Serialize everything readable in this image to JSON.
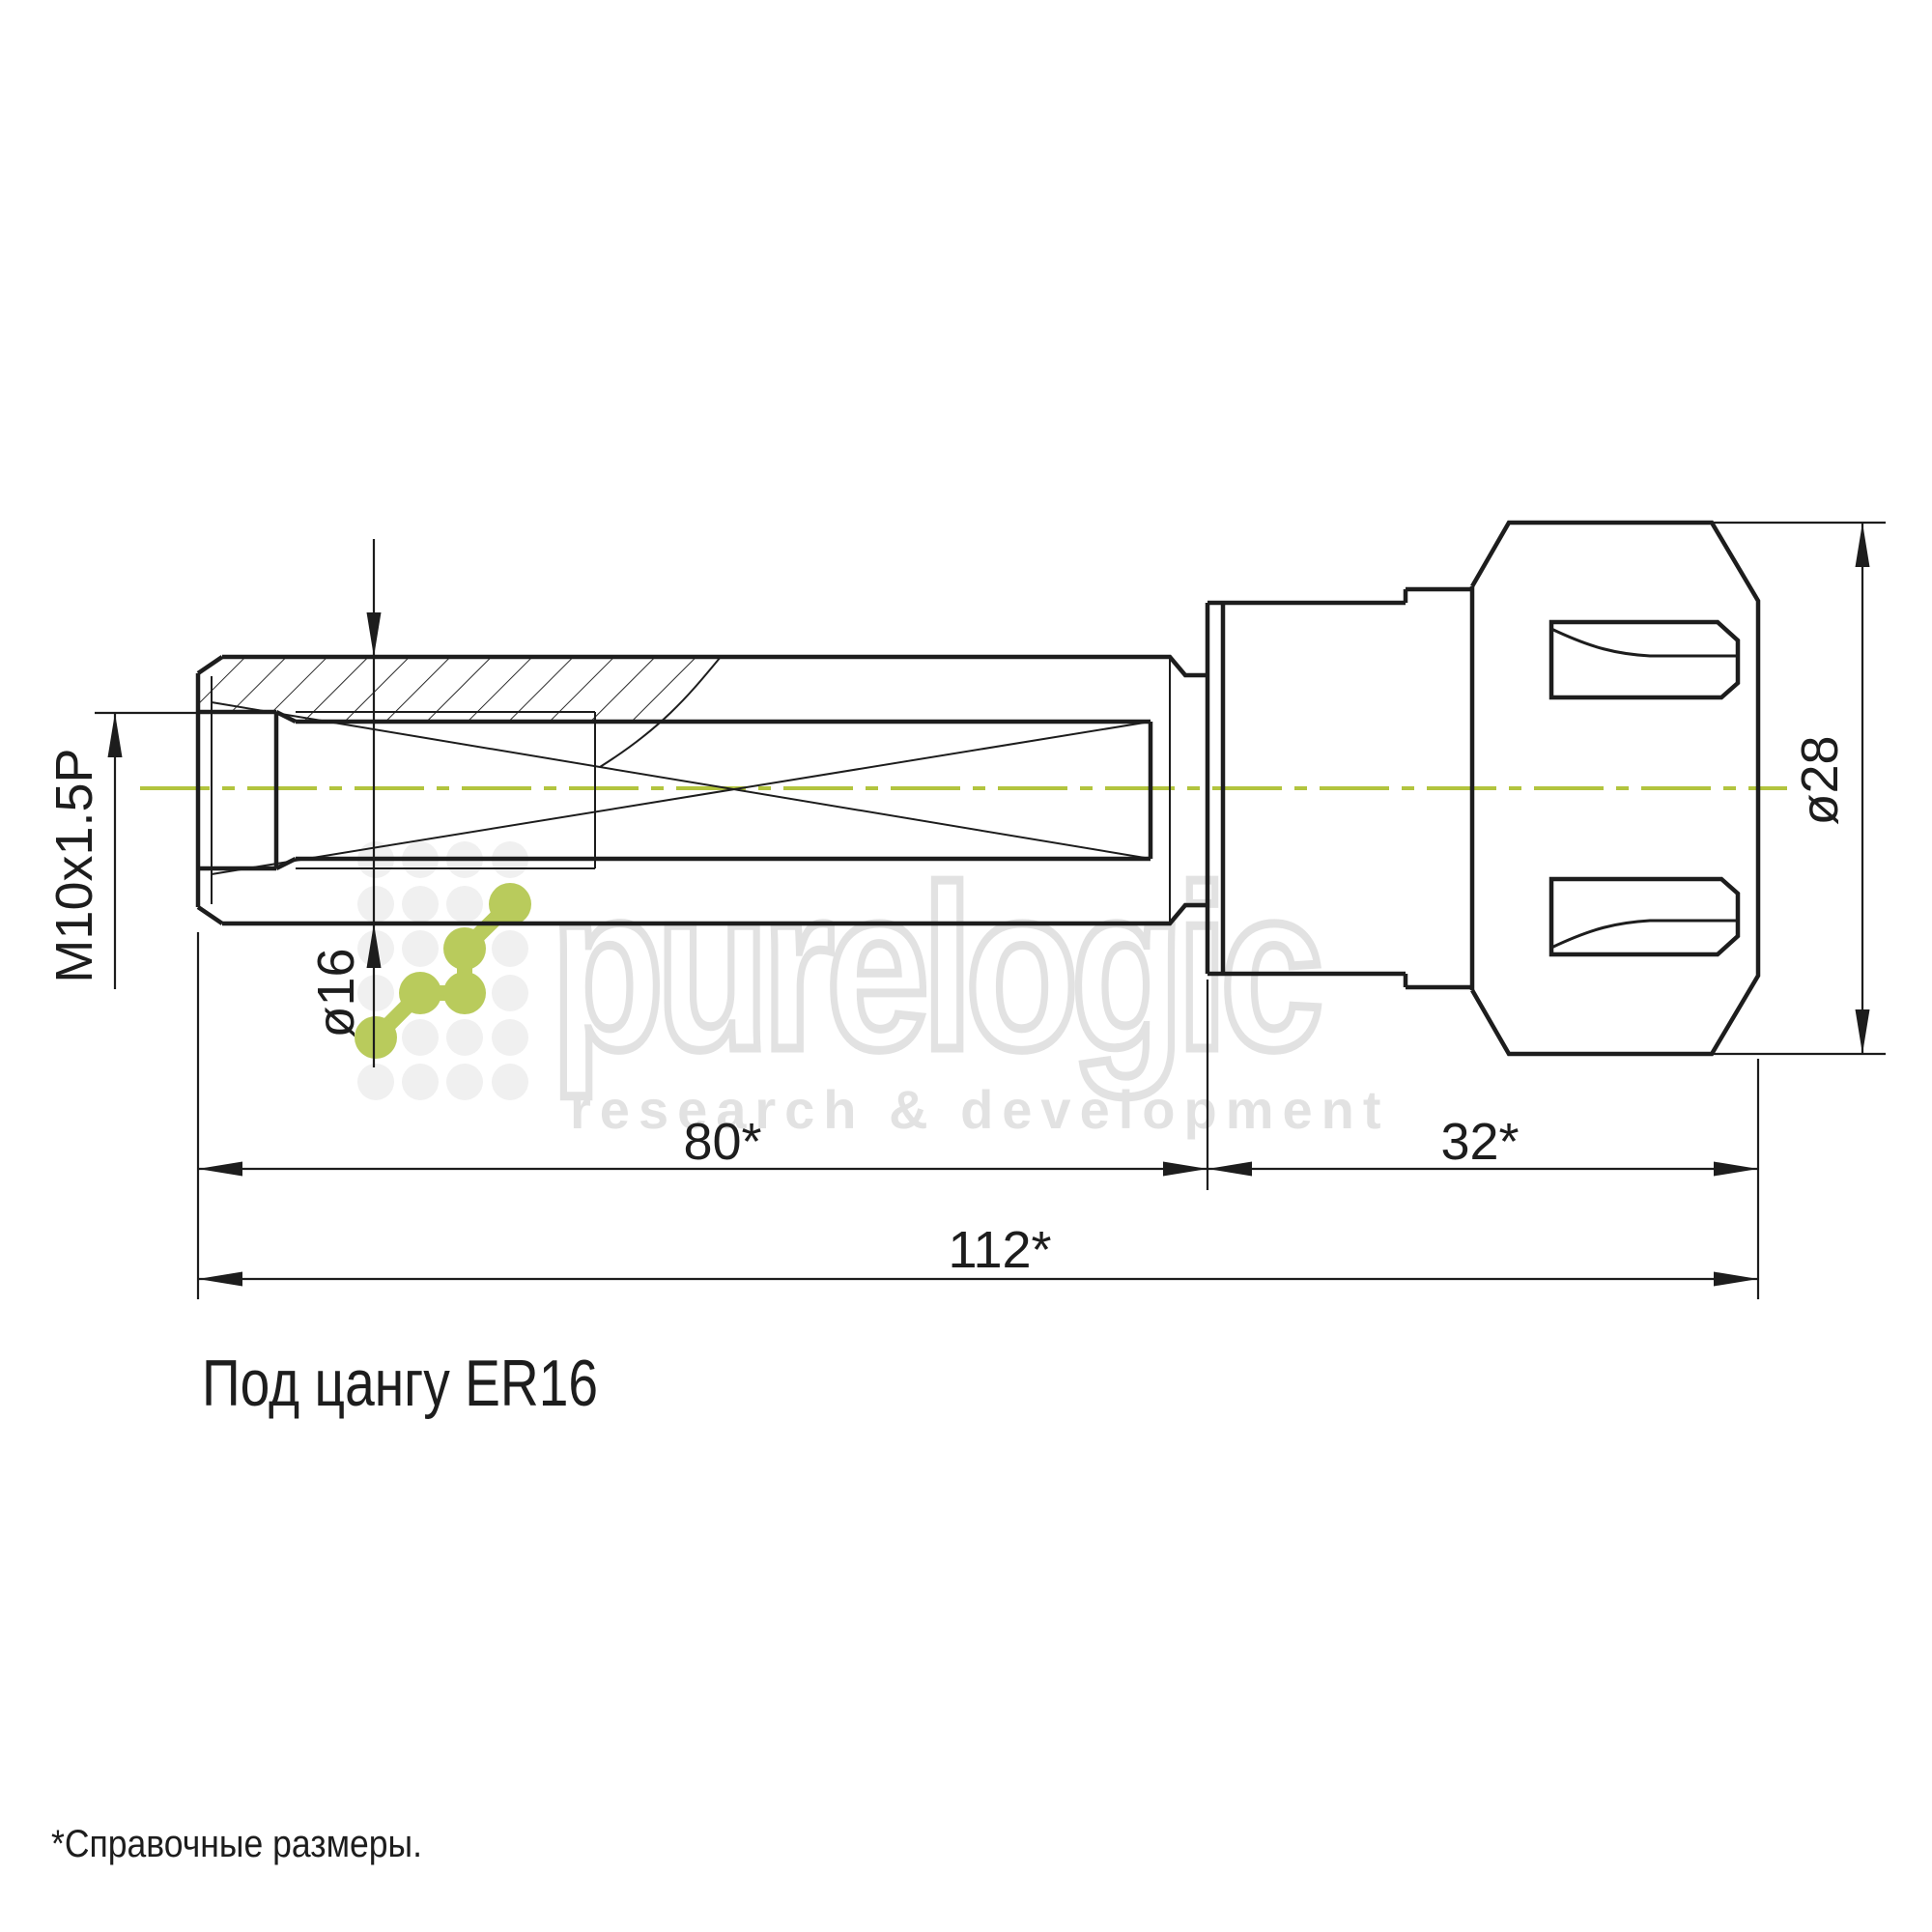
{
  "drawing": {
    "title": "Под цангу ER16",
    "footnote": "*Справочные размеры.",
    "labels": {
      "thread": "M10x1.5P",
      "shaft_diameter": "ø16",
      "nut_diameter": "ø28",
      "body_length": "80*",
      "nut_length": "32*",
      "overall_length": "112*"
    }
  },
  "watermark": {
    "brand": "purelogic",
    "tagline": "research & development"
  },
  "colors": {
    "centerline_green": "#b2c43e",
    "logo_green": "#b9cb5c",
    "ink": "#1d1d1d",
    "watermark_gray": "#e2e2e2"
  }
}
